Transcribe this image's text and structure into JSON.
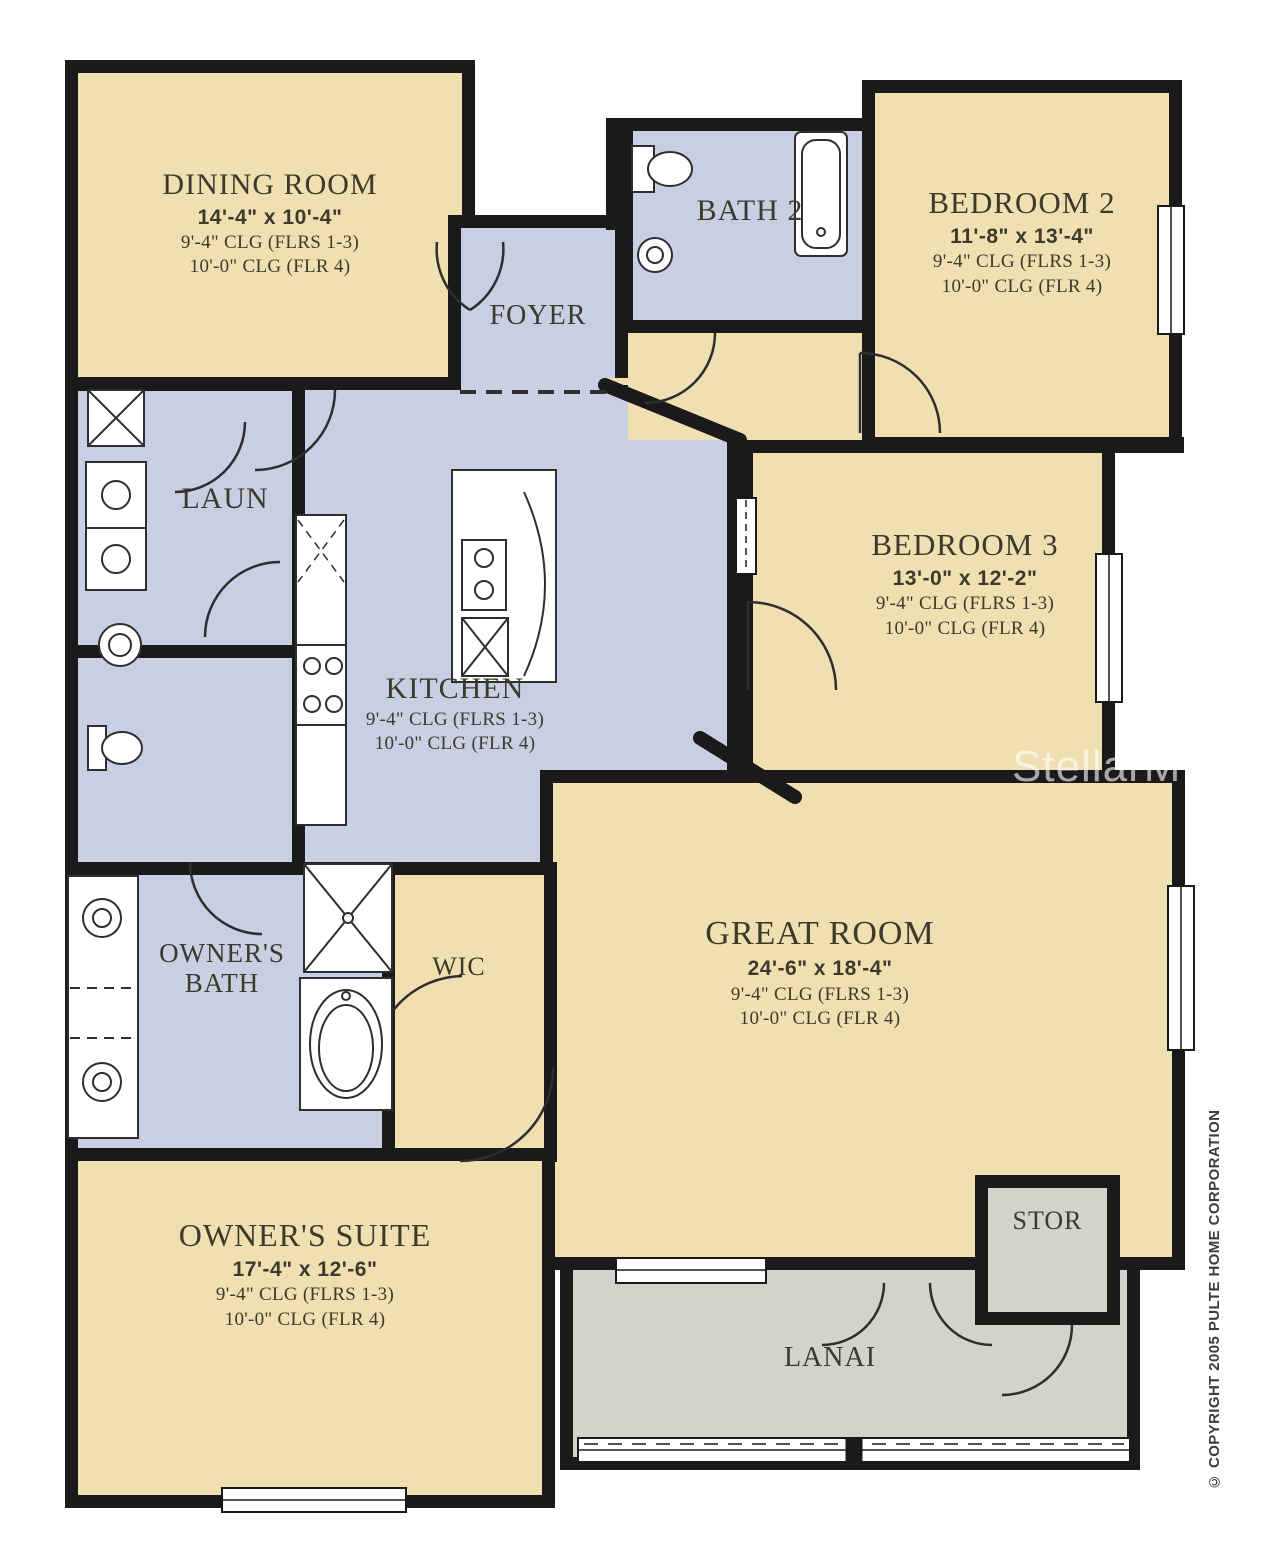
{
  "colors": {
    "wall": "#1a1a1a",
    "tan": "#efdfb1",
    "blue": "#c8cfe2",
    "gray": "#d2d3ca",
    "label": "#3c3a2a",
    "line": "#2e2e2e",
    "watermark": "rgba(255,255,255,0.62)",
    "copyright": "#3d3d3d"
  },
  "watermark": "StellarMLS",
  "copyright": "© COPYRIGHT 2005 PULTE HOME CORPORATION",
  "rooms": {
    "dining": {
      "name": "DINING ROOM",
      "dims": "14'-4\" x 10'-4\"",
      "clg_a": "9'-4\" CLG (FLRS 1-3)",
      "clg_b": "10'-0\" CLG (FLR 4)"
    },
    "foyer": {
      "name": "FOYER"
    },
    "bath2": {
      "name": "BATH 2"
    },
    "bedroom2": {
      "name": "BEDROOM 2",
      "dims": "11'-8\" x 13'-4\"",
      "clg_a": "9'-4\" CLG (FLRS 1-3)",
      "clg_b": "10'-0\" CLG (FLR 4)"
    },
    "laun": {
      "name": "LAUN"
    },
    "kitchen": {
      "name": "KITCHEN",
      "clg_a": "9'-4\" CLG (FLRS 1-3)",
      "clg_b": "10'-0\" CLG (FLR 4)"
    },
    "bedroom3": {
      "name": "BEDROOM 3",
      "dims": "13'-0\" x 12'-2\"",
      "clg_a": "9'-4\" CLG (FLRS 1-3)",
      "clg_b": "10'-0\" CLG (FLR 4)"
    },
    "owners_bath": {
      "name": "OWNER'S BATH"
    },
    "wic": {
      "name": "WIC"
    },
    "great": {
      "name": "GREAT ROOM",
      "dims": "24'-6\" x 18'-4\"",
      "clg_a": "9'-4\" CLG (FLRS 1-3)",
      "clg_b": "10'-0\" CLG (FLR 4)"
    },
    "owners_suite": {
      "name": "OWNER'S SUITE",
      "dims": "17'-4\" x 12'-6\"",
      "clg_a": "9'-4\" CLG (FLRS 1-3)",
      "clg_b": "10'-0\" CLG (FLR 4)"
    },
    "stor": {
      "name": "STOR"
    },
    "lanai": {
      "name": "LANAI"
    }
  }
}
